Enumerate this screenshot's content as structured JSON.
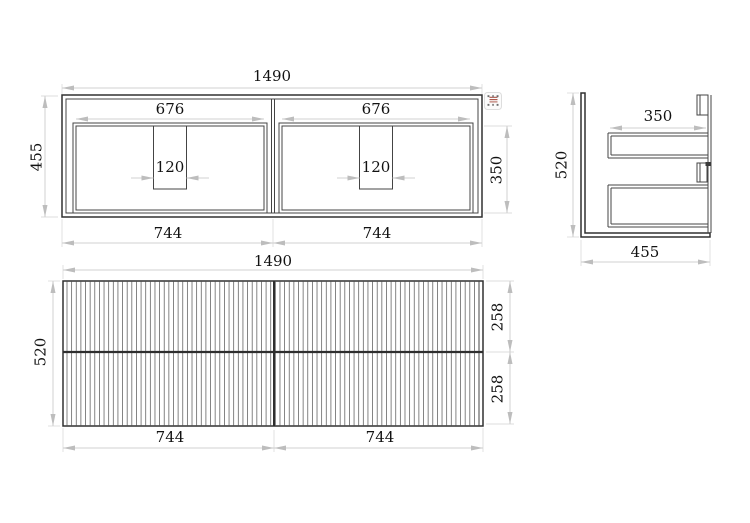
{
  "colors": {
    "background": "#ffffff",
    "geometry_line": "#3f3f3f",
    "dimension_line": "#d0d0d0",
    "dimension_text": "#141414",
    "grip_hatch": "#a84f42"
  },
  "plan_view": {
    "overall_width": "1490",
    "overall_depth": "455",
    "left_opening_width": "676",
    "right_opening_width": "676",
    "left_notch_width": "120",
    "right_notch_width": "120",
    "left_half_width": "744",
    "right_half_width": "744",
    "opening_depth": "350"
  },
  "side_view": {
    "height": "520",
    "depth": "455",
    "drawer_depth": "350"
  },
  "front_view": {
    "overall_width": "1490",
    "height": "520",
    "left_half_width": "744",
    "right_half_width": "744",
    "upper_drawer_height": "258",
    "lower_drawer_height": "258"
  }
}
